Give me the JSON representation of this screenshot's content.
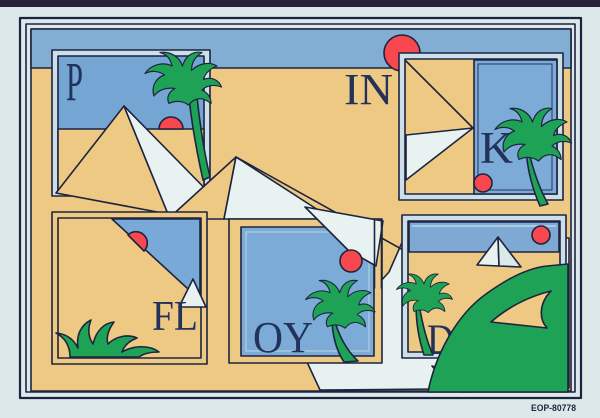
{
  "artwork": {
    "letters": {
      "panel_top_left": "P",
      "desert_text": "IN",
      "panel_top_right": "K",
      "panel_bottom_left": "FL",
      "panel_bottom_center": "OY",
      "panel_bottom_right": "D"
    },
    "catalog_code": "EOP-80778"
  },
  "colors": {
    "background": "#dde8ea",
    "photo_edge": "#272337",
    "line": "#1d2440",
    "letter": "#22325a",
    "sky_band": "#83aed4",
    "panel_sky": "#74a5d3",
    "panel_sky_light": "#7babd6",
    "sand": "#eec983",
    "pale_sheet": "#e7f1ef",
    "pyramid_white": "#e8f3f1",
    "green": "#1ea356",
    "red": "#f8484f"
  }
}
